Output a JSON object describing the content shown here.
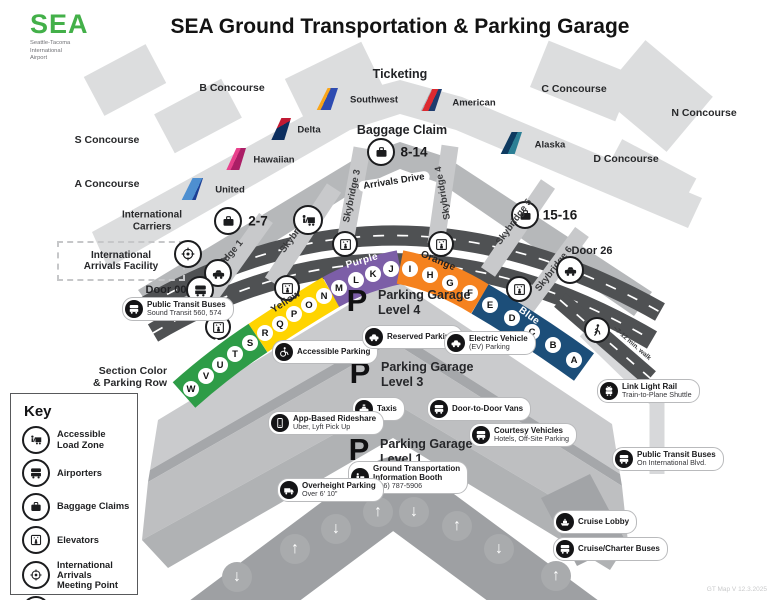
{
  "header": {
    "logo_brand": "SEA",
    "logo_sub1": "Seattle-Tacoma",
    "logo_sub2": "International",
    "logo_sub3": "Airport",
    "title": "SEA Ground Transportation & Parking Garage"
  },
  "terminal": {
    "concourse_b": "B Concourse",
    "concourse_c": "C Concourse",
    "concourse_n": "N Concourse",
    "concourse_s": "S Concourse",
    "concourse_d": "D Concourse",
    "concourse_a": "A Concourse",
    "international_carriers_1": "International",
    "international_carriers_2": "Carriers",
    "ticketing": "Ticketing",
    "baggage_claim": "Baggage Claim",
    "baggage_mid": "8-14",
    "baggage_left": "2-7",
    "baggage_right": "15-16",
    "airlines": {
      "southwest": "Southwest",
      "american": "American",
      "delta": "Delta",
      "hawaiian": "Hawaiian",
      "alaska": "Alaska",
      "united": "United"
    }
  },
  "roadway": {
    "arrivals_drive": "Arrivals Drive",
    "skybridge_1": "Skybridge 1",
    "skybridge_2": "Skybridge 2",
    "skybridge_3": "Skybridge 3",
    "skybridge_4": "Skybridge 4",
    "skybridge_5": "Skybridge 5",
    "skybridge_6": "Skybridge 6",
    "door_00": "Door 00",
    "door_26": "Door 26",
    "walk_note": "~7-12 min. walk"
  },
  "iaf": {
    "line1": "International",
    "line2": "Arrivals Facility"
  },
  "sections": {
    "green": {
      "label": "Green",
      "color": "#2E9C47"
    },
    "yellow": {
      "label": "Yellow",
      "color": "#FFD400"
    },
    "purple": {
      "label": "Purple",
      "color": "#7C5EA7"
    },
    "orange": {
      "label": "Orange",
      "color": "#F5821F"
    },
    "blue": {
      "label": "Blue",
      "color": "#1C4E79"
    }
  },
  "rows": {
    "heading_1": "Section Color",
    "heading_2": "& Parking Row",
    "letters": [
      "W",
      "V",
      "U",
      "T",
      "S",
      "R",
      "Q",
      "P",
      "O",
      "N",
      "M",
      "L",
      "K",
      "J",
      "I",
      "H",
      "G",
      "F",
      "E",
      "D",
      "C",
      "B",
      "A"
    ]
  },
  "garage": {
    "p": "P",
    "level4_1": "Parking Garage",
    "level4_2": "Level 4",
    "level3_1": "Parking Garage",
    "level3_2": "Level 3",
    "level1_1": "Parking Garage",
    "level1_2": "Level 1"
  },
  "callouts": {
    "transit_west": {
      "line1": "Public Transit Buses",
      "line2": "Sound Transit 560, 574"
    },
    "accessible": {
      "line1": "Accessible Parking"
    },
    "reserved": {
      "line1": "Reserved Parking"
    },
    "ev": {
      "line1": "Electric Vehicle",
      "line2": "(EV) Parking"
    },
    "taxis": {
      "line1": "Taxis"
    },
    "vans": {
      "line1": "Door-to-Door Vans"
    },
    "rideshare": {
      "line1": "App-Based Rideshare",
      "line2": "Uber, Lyft Pick Up"
    },
    "courtesy": {
      "line1": "Courtesy Vehicles",
      "line2": "Hotels, Off-Site Parking"
    },
    "info": {
      "line1": "Ground Transportation",
      "line2": "Information Booth",
      "line3": "(206) 787-5906"
    },
    "overheight": {
      "line1": "Overheight Parking",
      "line2": "Over 6' 10\""
    },
    "link": {
      "line1": "Link Light Rail",
      "line2": "Train-to-Plane Shuttle"
    },
    "transit_east": {
      "line1": "Public Transit Buses",
      "line2": "On International Blvd."
    },
    "cruise_lobby": {
      "line1": "Cruise Lobby"
    },
    "cruise_buses": {
      "line1": "Cruise/Charter Buses"
    }
  },
  "key": {
    "title": "Key",
    "items": [
      {
        "line1": "Accessible",
        "line2": "Load Zone"
      },
      {
        "line1": "Airporters",
        "line2": ""
      },
      {
        "line1": "Baggage Claims",
        "line2": ""
      },
      {
        "line1": "Elevators",
        "line2": ""
      },
      {
        "line1": "International Arrivals",
        "line2": "Meeting Point"
      },
      {
        "line1": "Rental Car",
        "line2": "Shuttle"
      }
    ]
  },
  "arrows": {
    "up": "↑",
    "down": "↓"
  },
  "footer": {
    "version": "GT Map V 12.3.2025"
  }
}
